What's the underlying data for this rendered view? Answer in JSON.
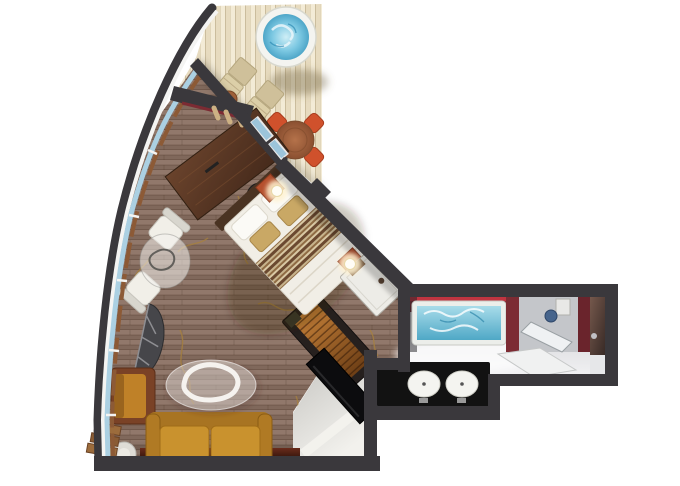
{
  "meta": {
    "title": "Cruise suite floor plan",
    "type": "floor-plan",
    "visible_text": ""
  },
  "palette": {
    "background": "#ffffff",
    "wall": "#3a383c",
    "deck": "#e7dbbf",
    "floor": "#8a7062",
    "floor_branch": "#a8823c",
    "window_glass": "#abd0e2",
    "window_frame": "#f4f4f2",
    "sill": "#8c5a36",
    "maroon": "#7c2b33",
    "accent_red": "#c03440",
    "hot_tub_water": "#58b6da",
    "tub_water": "#56b0d4",
    "sofa": "#c9922e",
    "armchair": "#bf8128",
    "dining_chair": "#d0512c",
    "deck_table": "#a8663c",
    "lounger": "#d8cba6",
    "desk_wood": "#5a3a26",
    "bed_linen": "#f1eee6",
    "bed_stripe": "#6b4930",
    "nightstand": "#b5502e",
    "lamp_glow": "#fff3d2",
    "closet_white": "#edece7",
    "bath_floor": "#ececee",
    "counter_black": "#121212",
    "door_brown": "#5c443c",
    "hall_floor": "#e3e2de",
    "console_red": "#5a2418"
  },
  "rooms": {
    "balcony": {
      "label": "balcony-deck",
      "items": [
        "hot-tub",
        "lounger",
        "lounger",
        "deck-side-table",
        "dining-table",
        "dining-chair",
        "dining-chair",
        "dining-chair",
        "dining-chair"
      ]
    },
    "living_room": {
      "label": "living-room",
      "items": [
        "writing-desk",
        "desk-chair",
        "lounge-chair",
        "lounge-chair",
        "glass-side-table",
        "half-round-table",
        "armchair",
        "round-side-table",
        "step-shelf",
        "sofa",
        "glass-coffee-table",
        "media-cabinet",
        "tv-panel",
        "wall-console"
      ]
    },
    "bedroom": {
      "label": "bedroom",
      "items": [
        "double-bed",
        "nightstand-lamp",
        "nightstand-lamp",
        "wardrobe-unit"
      ]
    },
    "entry_hall": {
      "label": "entry-hall",
      "items": [
        "hall-floor",
        "door-leaf"
      ]
    },
    "bathroom": {
      "label": "bathroom",
      "items": [
        "bathtub",
        "shower",
        "shower-head",
        "vanity-shelf",
        "double-sink-counter",
        "entry-door"
      ]
    }
  }
}
